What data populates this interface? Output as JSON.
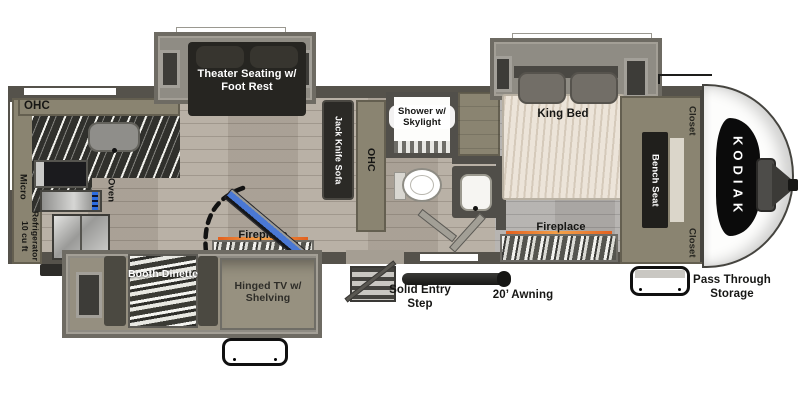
{
  "brand": "KODIAK",
  "labels": {
    "kitchen": {
      "ohc": "OHC",
      "micro": "Micro",
      "oven": "Oven",
      "refrigerator_line1": "10 cu ft",
      "refrigerator_line2": "Refrigerator"
    },
    "living": {
      "theater_seating": "Theater Seating w/ Foot Rest",
      "jack_knife_sofa": "Jack Knife Sofa",
      "ohc": "OHC",
      "fireplace": "Fireplace",
      "booth_dinette": "Booth Dinette",
      "hinged_tv": "Hinged TV w/ Shelving"
    },
    "bath": {
      "shower": "Shower w/ Skylight"
    },
    "bedroom": {
      "king_bed": "King Bed",
      "fireplace": "Fireplace",
      "closet_top": "Closet",
      "bench_seat": "Bench Seat",
      "closet_bottom": "Closet"
    },
    "exterior": {
      "solid_entry_step": "Solid Entry Step",
      "awning": "20’ Awning",
      "pass_through_storage": "Pass Through Storage"
    }
  },
  "colors": {
    "wall": "#55524b",
    "floor_wood": "#b4ab9f",
    "floor_bedroom": "#b2afac",
    "slide_shell": "#8f8c84",
    "cabinet_olive": "#8a8471",
    "seat_dark": "#262521",
    "mattress": "#ece4d9",
    "tv_screen_blue": "#4a78d4",
    "flame_accent": "#e2601f",
    "decal_black": "#0b0b0b"
  }
}
